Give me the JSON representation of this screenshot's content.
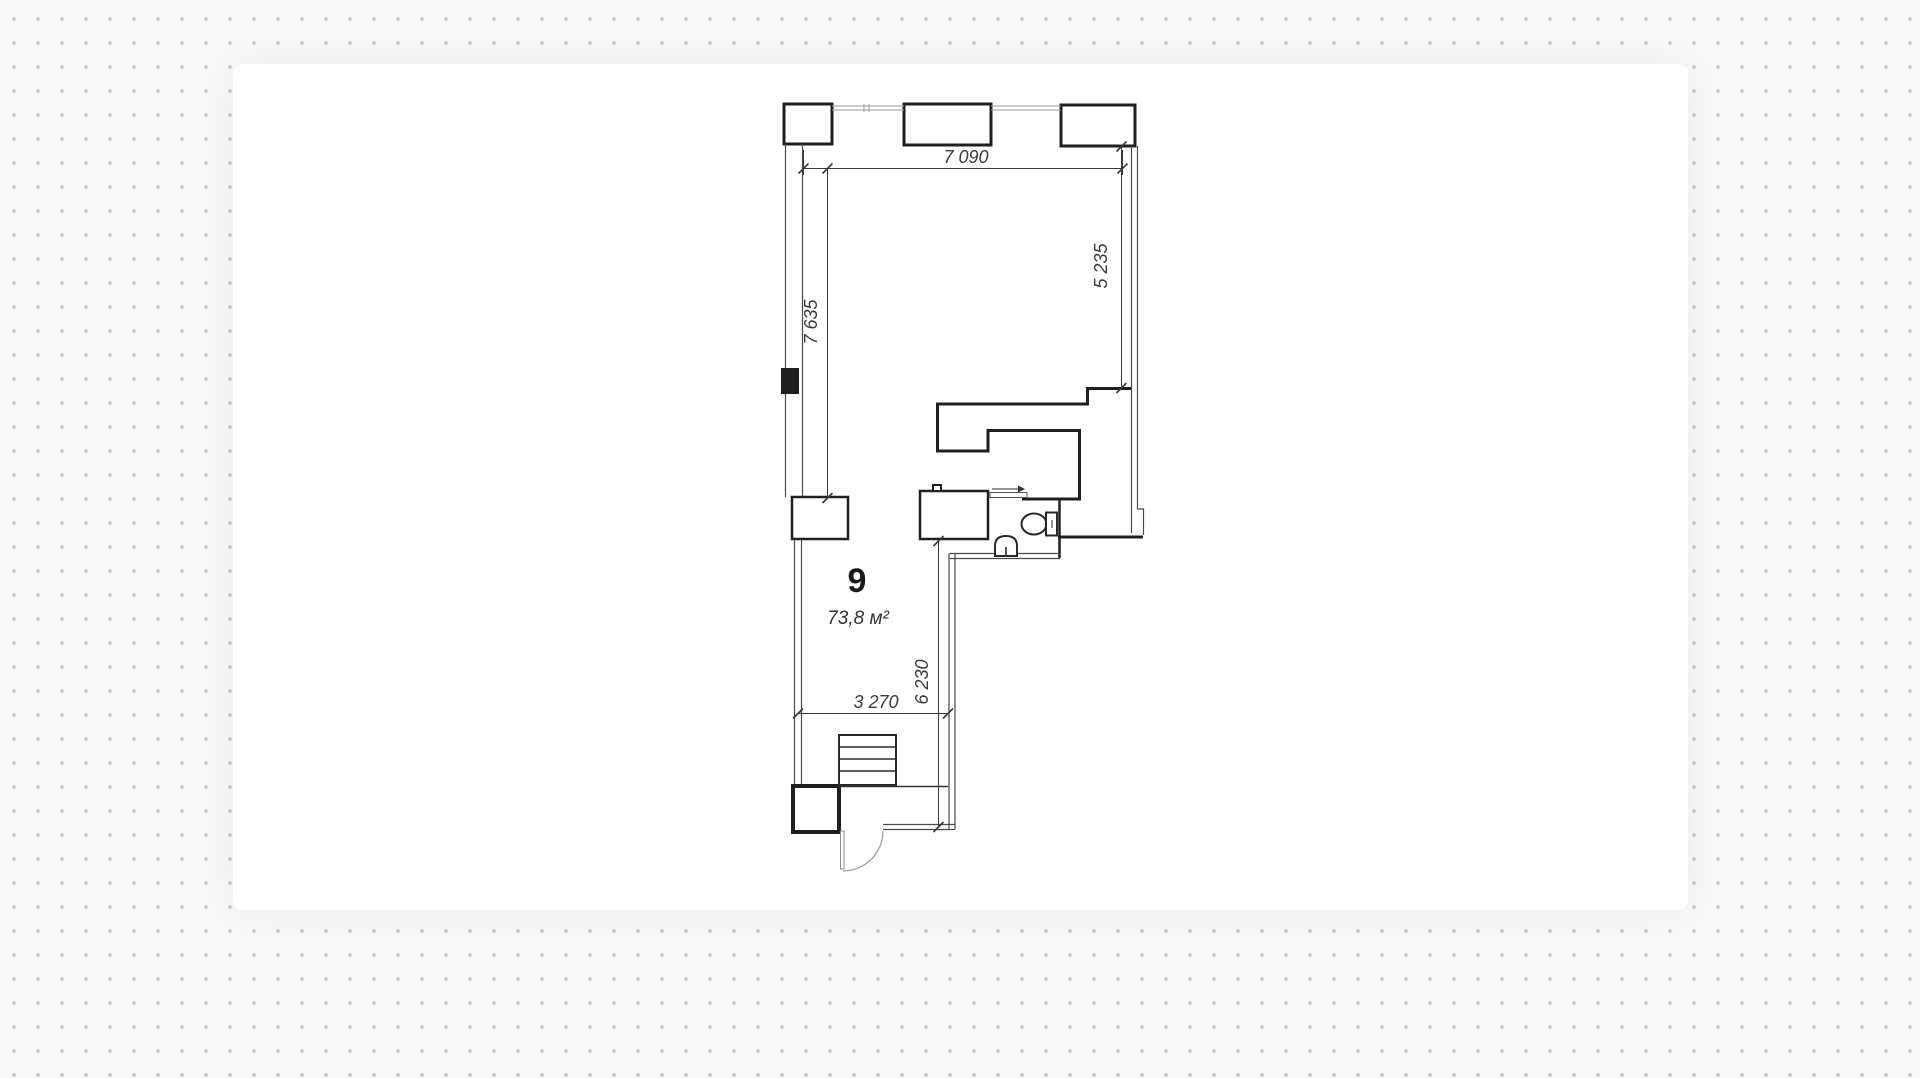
{
  "plan": {
    "unit_number": "9",
    "area_label": "73,8 м²",
    "dimensions": {
      "top_width": "7 090",
      "left_height": "7 635",
      "right_height": "5 235",
      "inner_height": "6 230",
      "bottom_width": "3 270"
    },
    "fixtures": [
      "toilet",
      "sink",
      "stairs",
      "entry-door",
      "sliding-door"
    ],
    "colors": {
      "wall": "#1f1f1f",
      "dim": "#3a3a3a",
      "card": "#ffffff",
      "dot": "#c7c7c7"
    }
  }
}
